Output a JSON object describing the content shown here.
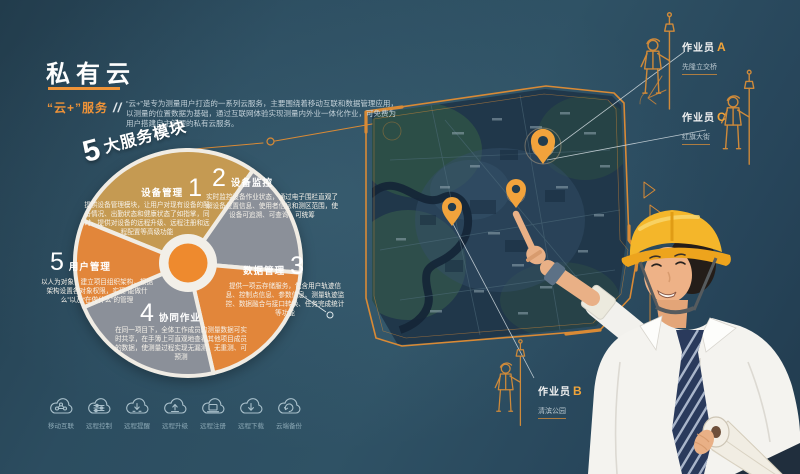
{
  "poster": {
    "title": "私有云",
    "subtitle": "“云+”服务",
    "subtitle_marks": "//",
    "intro": "“云+”是专为测量用户打造的一系列云服务，主要围绕着移动互联和数据管理应用，以测量的位置数据为基础，通过互联网体验实现测量内外业一体化作业，可免费为用户搭建自主管理的私有云服务。"
  },
  "modules_heading": {
    "number": "5",
    "text": "大服务模块"
  },
  "modules": [
    {
      "number": "1",
      "name": "设备管理",
      "desc": "提供设备管理模块，让用户对现有设备的配备情况、出勤状态和健康状态了如指掌，同时，提供对设备的远程升级、远程注册和远程配置等高级功能"
    },
    {
      "number": "2",
      "name": "设备监控",
      "desc": "实时监控设备作业状态，通过电子围栏直观了解设备位置信息、使用者信息和测区范围，使设备可追溯、可查询、可统筹"
    },
    {
      "number": "3",
      "name": "数据管理",
      "desc": "提供一项云存储服务，包含用户轨迹信息、控制点信息、参数信息、测量轨迹监控、数据融合与接口转换、任务完成统计等功能"
    },
    {
      "number": "4",
      "name": "协同作业",
      "desc": "在同一项目下，全体工作成员的测量数据可实时共享，在手簿上可直观地查看其他项目成员的数据，使测量过程实现无漏测、无重测、可预测"
    },
    {
      "number": "5",
      "name": "用户管理",
      "desc": "以人为对象，建立项目组织架构，根据架构设置各对象权限，实现“能做什么”以及“在做什么”的管理"
    }
  ],
  "cloud_features": [
    {
      "label": "移动互联",
      "icon": "mobile-internet-cloud-icon"
    },
    {
      "label": "远程控制",
      "icon": "remote-control-cloud-icon"
    },
    {
      "label": "远程提醒",
      "icon": "remote-reminder-cloud-icon"
    },
    {
      "label": "远程升级",
      "icon": "remote-upgrade-cloud-icon"
    },
    {
      "label": "远程注册",
      "icon": "remote-register-cloud-icon"
    },
    {
      "label": "远程下载",
      "icon": "remote-download-cloud-icon"
    },
    {
      "label": "云端备份",
      "icon": "cloud-backup-icon"
    }
  ],
  "workers": [
    {
      "name": "作业员",
      "letter": "A",
      "location": "先隆立交桥"
    },
    {
      "name": "作业员",
      "letter": "C",
      "location": "红旗大街"
    },
    {
      "name": "作业员",
      "letter": "B",
      "location": "清滨公园"
    }
  ],
  "colors": {
    "background": "#2c4d60",
    "accent_orange": "#ef9338",
    "sector_gold": "#c59a52",
    "sector_gray": "#8b9099",
    "sector_orange": "#e2863a",
    "pin_orange": "#f2a33c",
    "helmet_yellow": "#f4b62a",
    "icon_teal": "#a9c0cb"
  }
}
